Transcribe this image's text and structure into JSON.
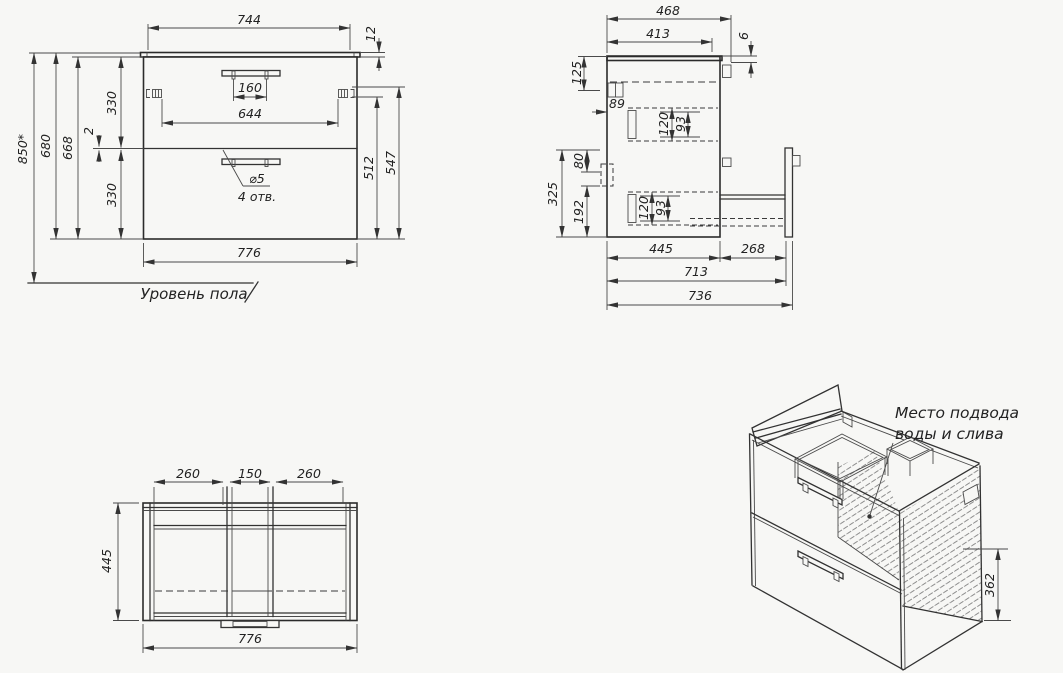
{
  "drawing": {
    "front": {
      "w744": "744",
      "t12": "12",
      "holes160": "160",
      "span644": "644",
      "up330": "330",
      "gap2": "2",
      "low330": "330",
      "h668": "668",
      "h680": "680",
      "h850": "850*",
      "r512": "512",
      "r547": "547",
      "w776": "776",
      "dia": "⌀5",
      "holes": "4 отв.",
      "floor": "Уровень пола"
    },
    "side": {
      "d468": "468",
      "d413": "413",
      "g6": "6",
      "v125": "125",
      "b89": "89",
      "u120": "120",
      "u93": "93",
      "v325": "325",
      "v80": "80",
      "v192": "192",
      "l120": "120",
      "l93": "93",
      "d445": "445",
      "d268": "268",
      "d713": "713",
      "d736": "736"
    },
    "top": {
      "l260": "260",
      "c150": "150",
      "r260": "260",
      "d445": "445",
      "w776": "776"
    },
    "iso": {
      "note1": "Место подвода",
      "note2": "воды и слива",
      "h362": "362"
    }
  }
}
